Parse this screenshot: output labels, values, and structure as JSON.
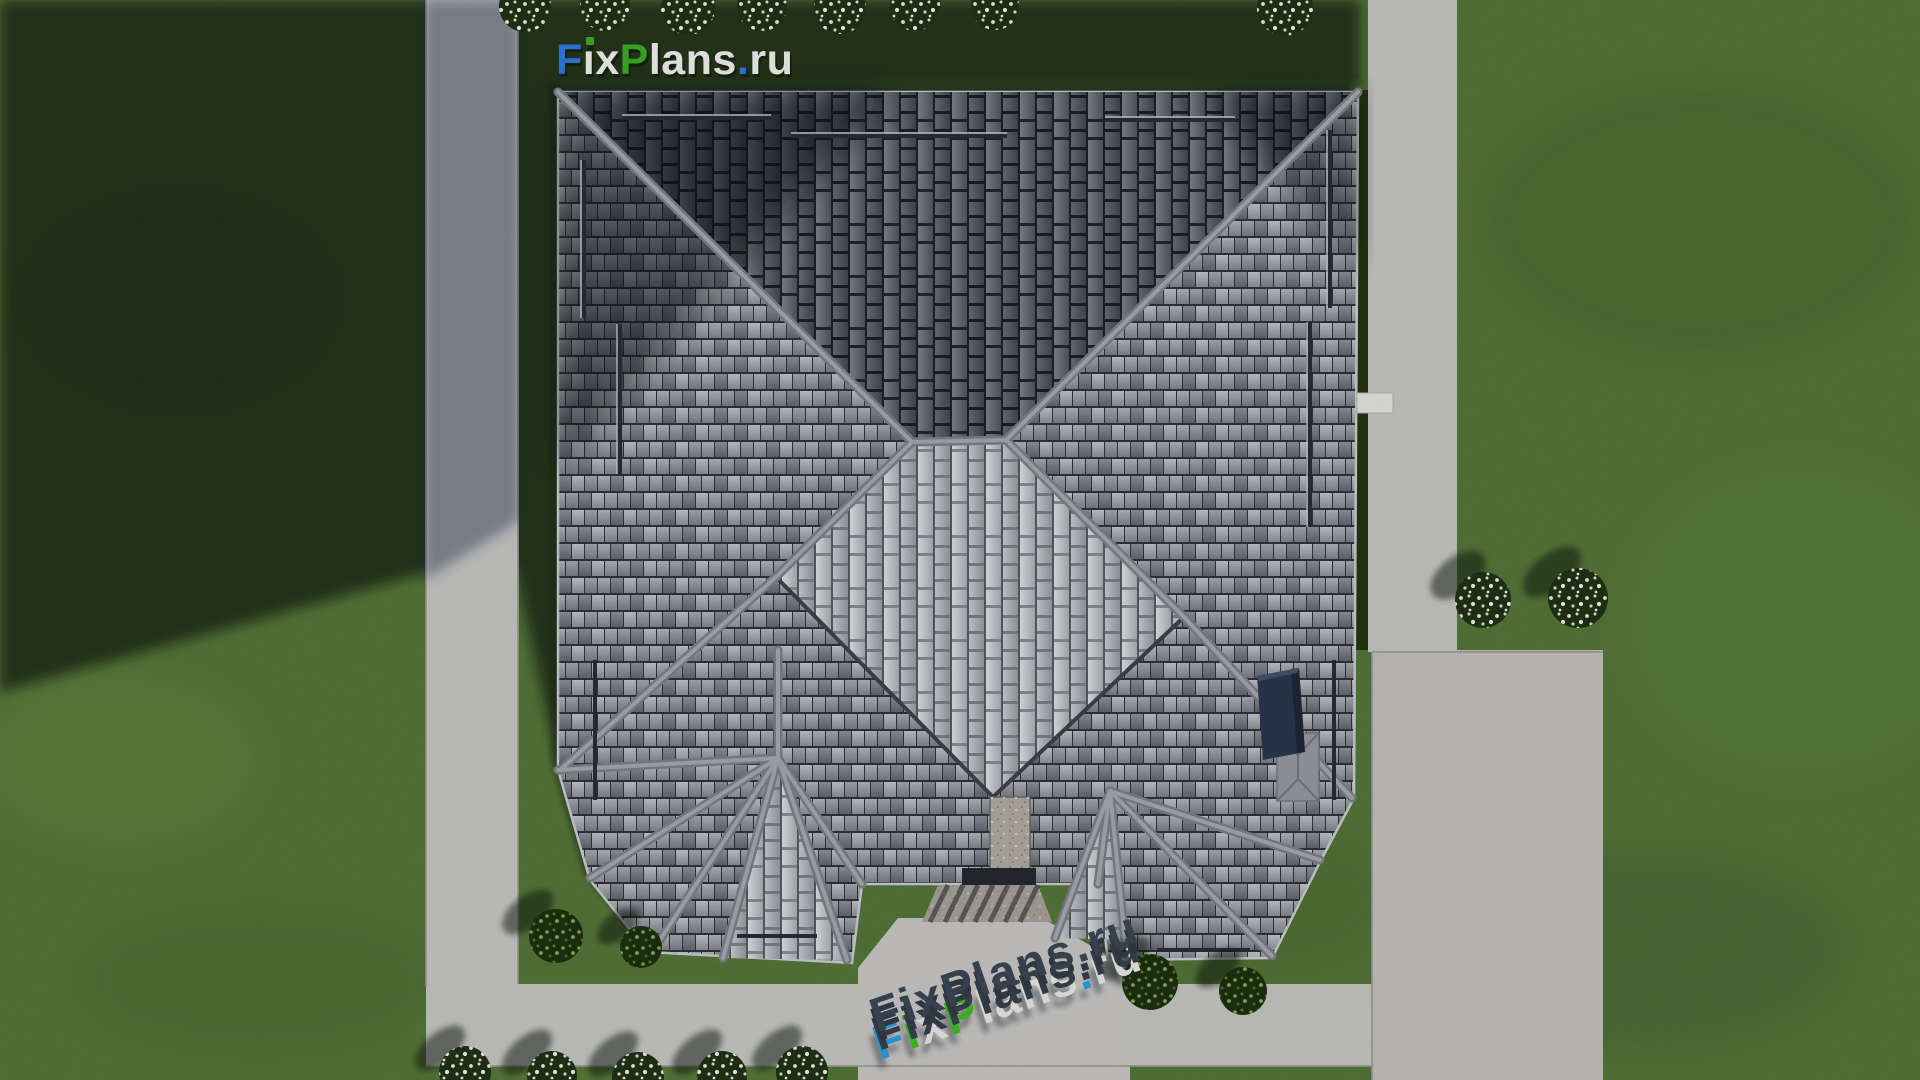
{
  "branding": {
    "logo": {
      "text": "FixPlans.ru",
      "parts": [
        {
          "t": "F",
          "c": "#2e7de2"
        },
        {
          "t": "ı",
          "c": "#f4f5f3"
        },
        {
          "t": "x",
          "c": "#f4f5f3"
        },
        {
          "t": "P",
          "c": "#3fae2a"
        },
        {
          "t": "lans",
          "c": "#f4f5f3"
        },
        {
          "t": ".",
          "c": "#2e7de2"
        },
        {
          "t": "ru",
          "c": "#f4f5f3"
        }
      ],
      "i_dot_color": "#3fae2a"
    },
    "watermark": {
      "text": "FixPlans.ru",
      "parts": [
        {
          "t": "F",
          "c": "#2b9fe8"
        },
        {
          "t": "i",
          "c": "#3ec321"
        },
        {
          "t": "x",
          "c": "#ececea"
        },
        {
          "t": "P",
          "c": "#3ec321"
        },
        {
          "t": "lans",
          "c": "#ececea"
        },
        {
          "t": ".",
          "c": "#2b9fe8"
        },
        {
          "t": "ru",
          "c": "#ececea"
        }
      ]
    }
  },
  "palette": {
    "grass": "#56783a",
    "grass_shadow": "#22301b",
    "concrete": "#c9c9c7",
    "patio_concrete": "#c6c5c3",
    "roof_tile_light": "#b4b7bd",
    "roof_tile_mid": "#8f939b",
    "roof_tile_dark": "#60646d",
    "roof_ridge": "#a9acb1",
    "diamond_tile_bright": "#d8dade",
    "chimney_navy": "#2c3850",
    "stone_chimney": "#b3afa6",
    "hedge_dark_green": "#24380f",
    "logo_blue": "#2e7de2",
    "logo_green": "#3fae2a",
    "watermark_blue": "#2b9fe8",
    "watermark_green": "#3ec321"
  }
}
